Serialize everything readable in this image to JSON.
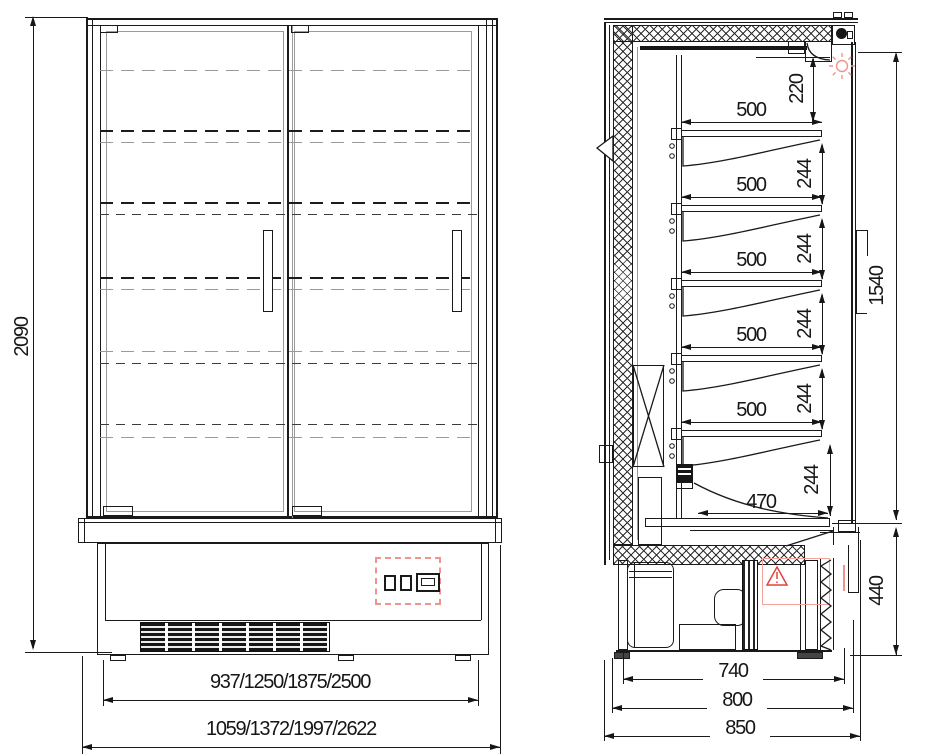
{
  "drawing_title": "refrigerated-multideck-cabinet-technical-drawing",
  "views": {
    "front": {
      "height": "2090",
      "inner_width": "937/1250/1875/2500",
      "overall_width": "1059/1372/1997/2622"
    },
    "side": {
      "top_gap": "220",
      "shelf_depths": [
        "500",
        "500",
        "500",
        "500",
        "500"
      ],
      "shelf_pitches": [
        "244",
        "244",
        "244",
        "244",
        "244"
      ],
      "bottom_shelf_depth": "470",
      "door_height": "1540",
      "base_height": "440",
      "base_depths": [
        "740",
        "800",
        "850"
      ]
    }
  },
  "colors": {
    "line": "#1a1a1a",
    "light_line": "#9a9a9a",
    "red_accent": "#e0443b",
    "salmon": "#f0938b"
  },
  "icons": {
    "light": "sun-rays-icon",
    "warning": "triangle-exclamation-icon",
    "controls": "thermostat-display-icon"
  }
}
